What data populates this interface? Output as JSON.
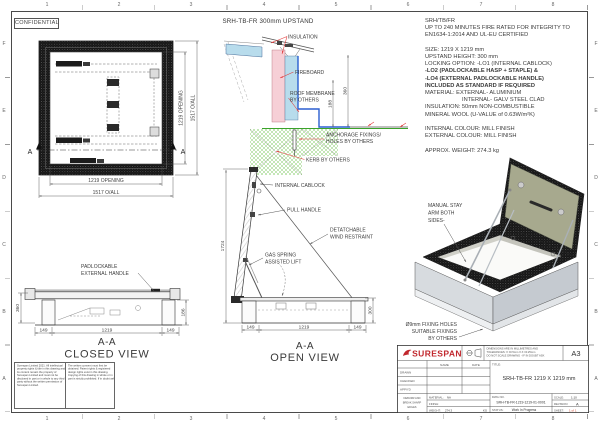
{
  "sheet": {
    "confidential": "CONFIDENTIAL",
    "cols": [
      "1",
      "2",
      "3",
      "4",
      "5",
      "6",
      "7",
      "8"
    ],
    "rows": [
      "F",
      "E",
      "D",
      "C",
      "B",
      "A"
    ]
  },
  "colors": {
    "brand_red": "#c1272d",
    "leader_red": "#e23c3c",
    "insulation_blue": "#b8dcec",
    "fireboard_pink": "#f6cfd6",
    "kerb_hatch_green": "#6bbf4a",
    "membrane_blue": "#2b5fd0",
    "seal_green": "#3aa32a",
    "lid_inner_olive": "#a7a98e",
    "sheet_value_red": "#cc3a22"
  },
  "plan": {
    "dim_opening_v": "1219 OPENING",
    "dim_overall_v": "1517 O/ALL",
    "dim_opening_b": "1219 OPENING",
    "dim_overall_b": "1517 O/ALL",
    "sec_left": "A",
    "sec_right": "A"
  },
  "section": {
    "title": "SRH-TB-FR 300mm UPSTAND",
    "insulation": "INSULATION",
    "fireboard": "FIREBOARD",
    "membrane1": "ROOF MEMBRANE",
    "membrane2": "BY OTHERS",
    "anchorage1": "ANCHORAGE FIXINGS/",
    "anchorage2": "HOLES BY OTHERS",
    "kerb": "KERB BY OTHERS",
    "dim360": "360",
    "dim188": "188"
  },
  "spec": {
    "lines": [
      "SRH/TB/FR",
      "UP TO 240 MINUTES FIRE RATED FOR INTEGRITY TO",
      "EN1634-1:2014 AND UL-EU CERTIFIED",
      "",
      "SIZE: 1219 X 1219 mm",
      "UPSTAND HEIGHT: 300 mm",
      "LOCKING OPTION: -LO1 (INTERNAL CABLOCK)",
      "-LO2 (PADLOCKABLE HASP + STAPLE) &",
      "-LO4 (EXTERNAL PADLOCKABLE HANDLE)",
      "INCLUDED AS STANDARD IF REQUIRED",
      "MATERIAL: EXTERNAL- ALUMINIUM",
      "INTERNAL- GALV STEEL CLAD",
      "INSULATION: 50mm NON-COMBUSTIBLE",
      "MINERAL WOOL (U-VALUE of 0.63W/m²K)",
      "",
      "INTERNAL COLOUR: MILL FINISH",
      "EXTERNAL COLOUR: MILL FINISH",
      "",
      "APPROX. WEIGHT: 274.3 kg"
    ]
  },
  "closed": {
    "label1": "PADLOCKABLE",
    "label2": "EXTERNAL HANDLE",
    "dim_left": "360",
    "dim_right": "186",
    "dim_b1": "149",
    "dim_b2": "1219",
    "dim_b3": "149",
    "title": "A-A",
    "subtitle": "CLOSED VIEW"
  },
  "open": {
    "cablock": "INTERNAL CABLOCK",
    "pull": "PULL HANDLE",
    "wind1": "DETATCHABLE",
    "wind2": "WIND RESTRAINT",
    "gas1": "GAS SPRING",
    "gas2": "ASSISTED LIFT",
    "dim_left": "1724",
    "dim_right": "300",
    "dim_b1": "149",
    "dim_b2": "1219",
    "dim_b3": "149",
    "title": "A-A",
    "subtitle": "OPEN VIEW"
  },
  "iso": {
    "stay1": "MANUAL STAY",
    "stay2": "ARM BOTH",
    "stay3": "SIDES-",
    "fix1": "Ø9mm FIXING HOLES",
    "fix2": "SUITABLE FIXINGS",
    "fix3": "BY OTHERS"
  },
  "tb": {
    "brand": "SURESPAN",
    "note1": "DIMENSIONS ARE IN MILLIMETRES AND",
    "note2": "TOLERANCES: X ±0.5mm  X.X ±0.25mm",
    "note3": "DO NOT SCALE DRAWING - IF IN DOUBT ASK",
    "size": "A3",
    "name": "NAME",
    "date": "DATE",
    "drawn": "DRAWN",
    "checked": "CHECKED",
    "appvd": "APPV'D",
    "deburr1": "DEBURR AND",
    "deburr2": "BREAK SHARP",
    "deburr3": "EDGES",
    "title_label": "TITLE:",
    "title": "SRH-TB-FR 1219 X 1219 mm",
    "material_label": "MATERIAL:",
    "material": "NA",
    "finish_label": "FINISH:",
    "weight_label": "WEIGHT:",
    "weight": "274.3",
    "weight_unit": "KG",
    "dwg_label": "DWG NO.",
    "dwg_no": "SRH-TB-FR-1219-1219-01-0001",
    "status_label": "STATUS:",
    "status": "Work In Progress",
    "scale_label": "SCALE:",
    "scale": "1:10",
    "revision_label": "REVISION:",
    "revision": "A",
    "sheet_label": "SHEET:",
    "sheet": "1 of 1"
  },
  "copyright": {
    "col1": "Surespan Limited 2021. All intellectual property rights & title in this drawing and its content remain the property of Surespan Limited and must not be disclosed in part or in whole to any third party without the written permission of Surespan Limited.",
    "col2": "The written consent must first be obtained. Patent rights & registered design rights exist in this drawing. Copying of this drawing in whole or in part is strictly prohibited. If in doubt ask."
  }
}
